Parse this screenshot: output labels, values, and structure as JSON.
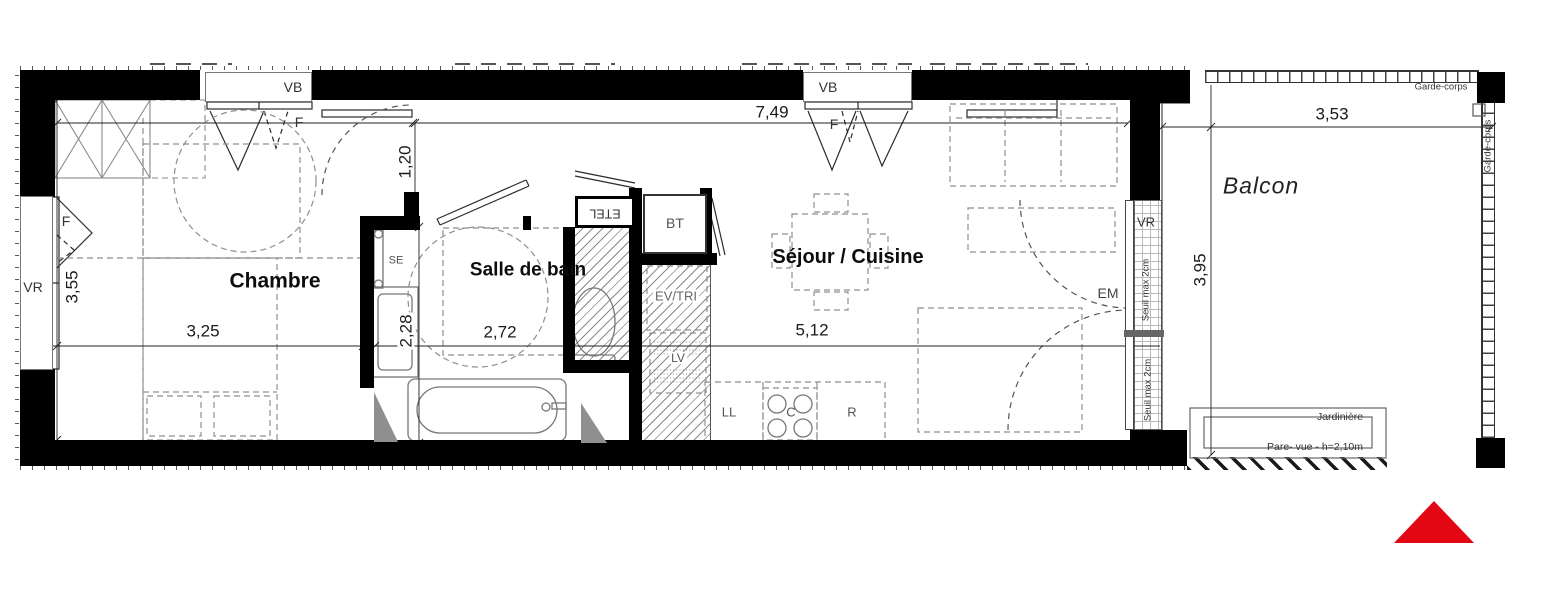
{
  "rooms": {
    "bedroom": "Chambre",
    "bathroom": "Salle de bain",
    "living": "Séjour / Cuisine",
    "balcony": "Balcon"
  },
  "dimensions": {
    "living_width": "7,49",
    "hall_width": "1,20",
    "bedroom_height": "3,55",
    "bedroom_width": "3,25",
    "bathroom_height": "2,28",
    "bathroom_width": "2,72",
    "living_span": "5,12",
    "balcony_width": "3,53",
    "balcony_depth": "3,95"
  },
  "openings": {
    "window_vb": "VB",
    "window_f": "F",
    "shutter_vr": "VR"
  },
  "equipment": {
    "towel_dryer": "SE",
    "etel": "ETEL",
    "bt": "BT",
    "sink_sorting": "EV/TRI",
    "dishwasher": "LV",
    "washer": "LL",
    "cooktop": "C",
    "fridge": "R",
    "em": "EM"
  },
  "balcony_items": {
    "guardrail": "Garde-corps",
    "planter": "Jardinière",
    "privacy_screen": "Pare- vue - h=2,10m",
    "threshold": "Seuil max 2cm"
  },
  "logo_color": "#e30613"
}
